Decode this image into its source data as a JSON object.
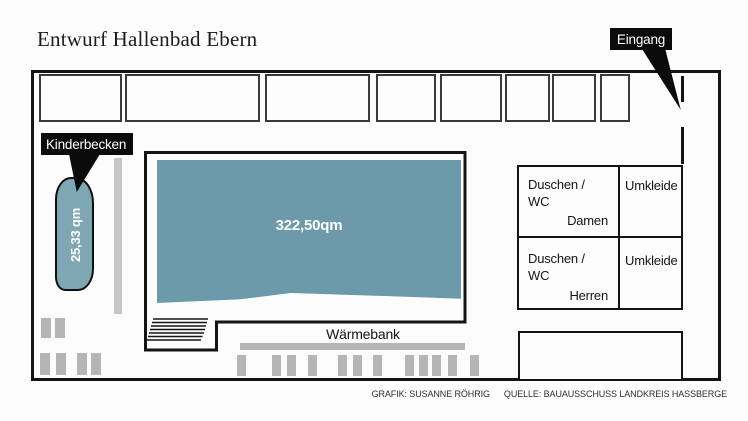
{
  "title": "Entwurf Hallenbad Ebern",
  "callouts": {
    "eingang": "Eingang",
    "kinderbecken": "Kinderbecken"
  },
  "pools": {
    "main": {
      "label": "322,50qm",
      "color": "#6d9aaa"
    },
    "kinder": {
      "label": "25,33 qm",
      "color": "#7fa6b3"
    }
  },
  "waermebank": {
    "label": "Wärmebank"
  },
  "rooms": {
    "damen": {
      "line1": "Duschen /",
      "line2": "WC",
      "name": "Damen"
    },
    "herren": {
      "line1": "Duschen /",
      "line2": "WC",
      "name": "Herren"
    },
    "umkleide_top": {
      "label": "Umkleide"
    },
    "umkleide_bottom": {
      "label": "Umkleide"
    }
  },
  "credit": {
    "grafik": "GRAFIK: SUSANNE RÖHRIG",
    "quelle": "QUELLE: BAUAUSSCHUSS LANDKREIS HASSBERGE"
  },
  "colors": {
    "wall": "#141414",
    "furniture_gray": "#b5b5b5",
    "pillar_gray": "#c6c6c6",
    "label_bg": "#0b0b0b"
  }
}
